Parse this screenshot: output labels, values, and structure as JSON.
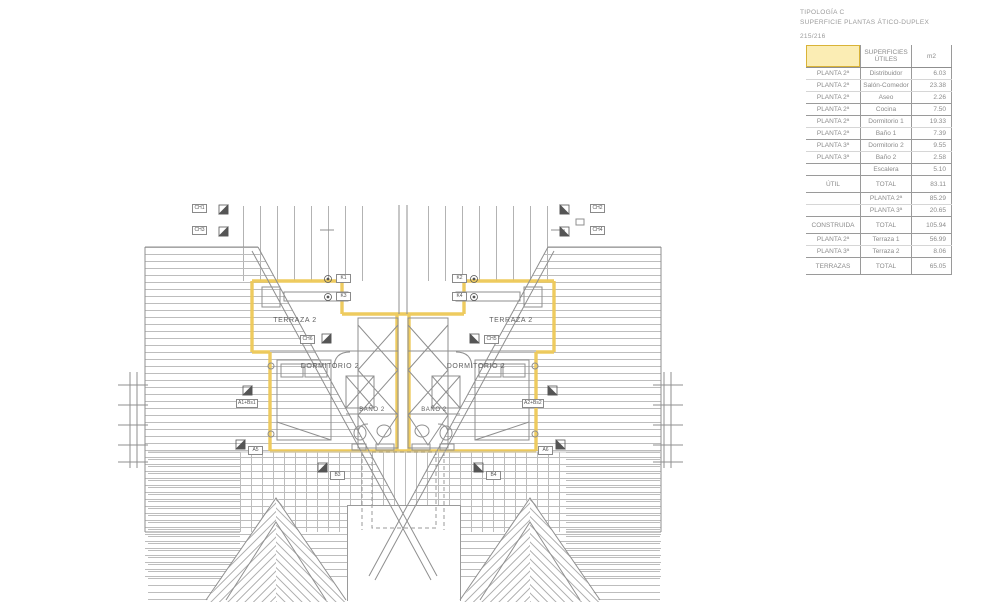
{
  "title": {
    "line1": "TIPOLOGÍA C",
    "line2": "SUPERFICIE PLANTAS ÁTICO-DUPLEX",
    "sheet": "215/216"
  },
  "table": {
    "header": {
      "col1": "",
      "col2": "SUPERFICIES ÚTILES",
      "col3": "m2"
    },
    "rows": [
      {
        "c1": "PLANTA 2ª",
        "c2": "Distribuidor",
        "c3": "6.03"
      },
      {
        "c1": "PLANTA 2ª",
        "c2": "Salón-Comedor",
        "c3": "23.38"
      },
      {
        "c1": "PLANTA 2ª",
        "c2": "Aseo",
        "c3": "2.26",
        "sep": true
      },
      {
        "c1": "PLANTA 2ª",
        "c2": "Cocina",
        "c3": "7.50",
        "sep": true
      },
      {
        "c1": "PLANTA 2ª",
        "c2": "Dormitorio 1",
        "c3": "19.33"
      },
      {
        "c1": "PLANTA 2ª",
        "c2": "Baño 1",
        "c3": "7.39",
        "sep": true
      },
      {
        "c1": "PLANTA 3ª",
        "c2": "Dormitorio 2",
        "c3": "9.55"
      },
      {
        "c1": "PLANTA 3ª",
        "c2": "Baño 2",
        "c3": "2.58",
        "sep": true
      },
      {
        "c1": "",
        "c2": "Escalera",
        "c3": "5.10",
        "sep": true
      },
      {
        "c1": "ÚTIL",
        "c2": "TOTAL",
        "c3": "83.11",
        "sep": true,
        "total": true
      },
      {
        "c1": "",
        "c2": "PLANTA 2ª",
        "c3": "85.29"
      },
      {
        "c1": "",
        "c2": "PLANTA 3ª",
        "c3": "20.65",
        "sep": true
      },
      {
        "c1": "CONSTRUIDA",
        "c2": "TOTAL",
        "c3": "105.94",
        "sep": true,
        "total": true
      },
      {
        "c1": "PLANTA 2ª",
        "c2": "Terraza 1",
        "c3": "56.99"
      },
      {
        "c1": "PLANTA 3ª",
        "c2": "Terraza 2",
        "c3": "8.06",
        "sep": true
      },
      {
        "c1": "TERRAZAS",
        "c2": "TOTAL",
        "c3": "65.05",
        "sep": true,
        "total": true
      }
    ]
  },
  "plan": {
    "rooms": {
      "terraza_left": "TERRAZA 2",
      "terraza_right": "TERRAZA 2",
      "dormitorio_left": "DORMITORIO 2",
      "dormitorio_right": "DORMITORIO 2",
      "bano_left": "BAÑO 2",
      "bano_right": "BAÑO 2"
    },
    "codes": {
      "ch1": "CH1",
      "ch3": "CH3",
      "ch2": "CH2",
      "ch4": "CH4",
      "k1": "K1",
      "k3": "K3",
      "k2": "K2",
      "k4": "K4",
      "ch6": "CH6",
      "ch5": "CH5",
      "a1": "A1+Bs1",
      "a2": "A2+Bs2",
      "a5": "A5",
      "a6": "A6",
      "b3": "B3",
      "b4": "B4"
    }
  },
  "colors": {
    "highlight_wall": "#eec957",
    "table_header_fill": "#fbedb4",
    "table_header_border": "#d9b337",
    "line_gray": "#8f8f8f"
  }
}
